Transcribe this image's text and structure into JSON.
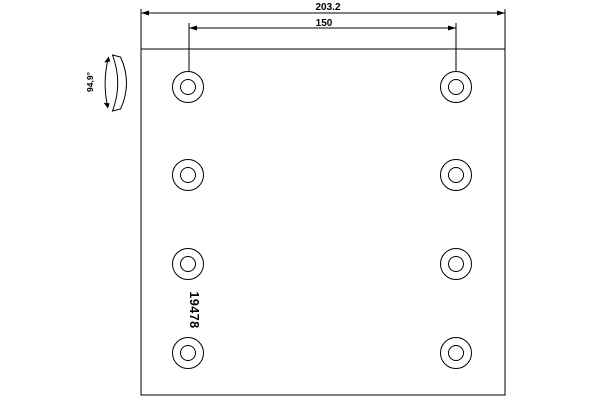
{
  "drawing": {
    "part_number": "19478",
    "dim_overall_width": "203.2",
    "dim_hole_spacing": "150",
    "dim_arc_angle": "94,9°",
    "holes": {
      "count": 8,
      "columns": 2,
      "rows": 4
    },
    "colors": {
      "line": "#000000",
      "background": "#ffffff"
    }
  }
}
